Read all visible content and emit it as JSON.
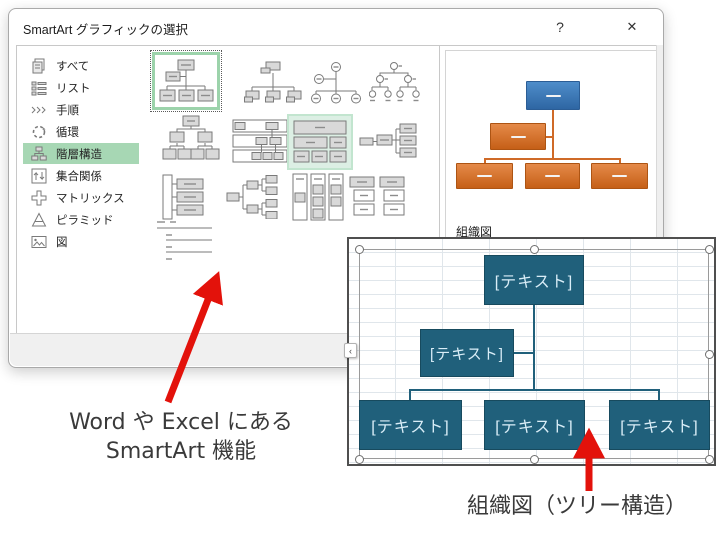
{
  "dialog": {
    "title": "SmartArt グラフィックの選択",
    "help_button": "?",
    "close_button": "✕",
    "sidebar": {
      "items": [
        {
          "label": "すべて",
          "icon": "all-icon",
          "selected": false
        },
        {
          "label": "リスト",
          "icon": "list-icon",
          "selected": false
        },
        {
          "label": "手順",
          "icon": "process-icon",
          "selected": false
        },
        {
          "label": "循環",
          "icon": "cycle-icon",
          "selected": false
        },
        {
          "label": "階層構造",
          "icon": "hierarchy-icon",
          "selected": true
        },
        {
          "label": "集合関係",
          "icon": "relationship-icon",
          "selected": false
        },
        {
          "label": "マトリックス",
          "icon": "matrix-icon",
          "selected": false
        },
        {
          "label": "ピラミッド",
          "icon": "pyramid-icon",
          "selected": false
        },
        {
          "label": "図",
          "icon": "picture-icon",
          "selected": false
        }
      ]
    },
    "gallery": {
      "selected_category": "階層構造",
      "thumbnails": [
        {
          "name": "organization-chart",
          "state": "selected"
        },
        {
          "name": "name-and-title-organization-chart",
          "state": "normal"
        },
        {
          "name": "half-circle-organization-chart",
          "state": "normal"
        },
        {
          "name": "circle-picture-hierarchy",
          "state": "normal"
        },
        {
          "name": "hierarchy",
          "state": "normal"
        },
        {
          "name": "labeled-hierarchy",
          "state": "normal"
        },
        {
          "name": "table-hierarchy",
          "state": "highlighted"
        },
        {
          "name": "horizontal-organization-chart",
          "state": "normal"
        },
        {
          "name": "vertical-organization-chart",
          "state": "normal"
        },
        {
          "name": "horizontal-hierarchy",
          "state": "normal"
        },
        {
          "name": "vertical-box-list",
          "state": "normal"
        },
        {
          "name": "stacked-list",
          "state": "normal"
        },
        {
          "name": "lineage-list",
          "state": "normal"
        }
      ]
    },
    "preview": {
      "caption": "組織図"
    }
  },
  "worksheet": {
    "smartart": {
      "top_node": "[テキスト]",
      "assistant_node": "[テキスト]",
      "child_nodes": [
        "[テキスト]",
        "[テキスト]",
        "[テキスト]"
      ],
      "text_pane_toggle": "‹"
    }
  },
  "annotations": {
    "gallery_note_line1": "Word や Excel にある",
    "gallery_note_line2": "SmartArt 機能",
    "chart_note": "組織図（ツリー構造）"
  },
  "colors": {
    "sidebar_selected_green": "#a7d7b4",
    "thumbnail_selected_green": "#9cd3ab",
    "smartart_node_teal": "#20607b",
    "preview_top_blue": "#3a78b8",
    "preview_orange": "#d3702c",
    "annotation_red": "#e3120b"
  }
}
